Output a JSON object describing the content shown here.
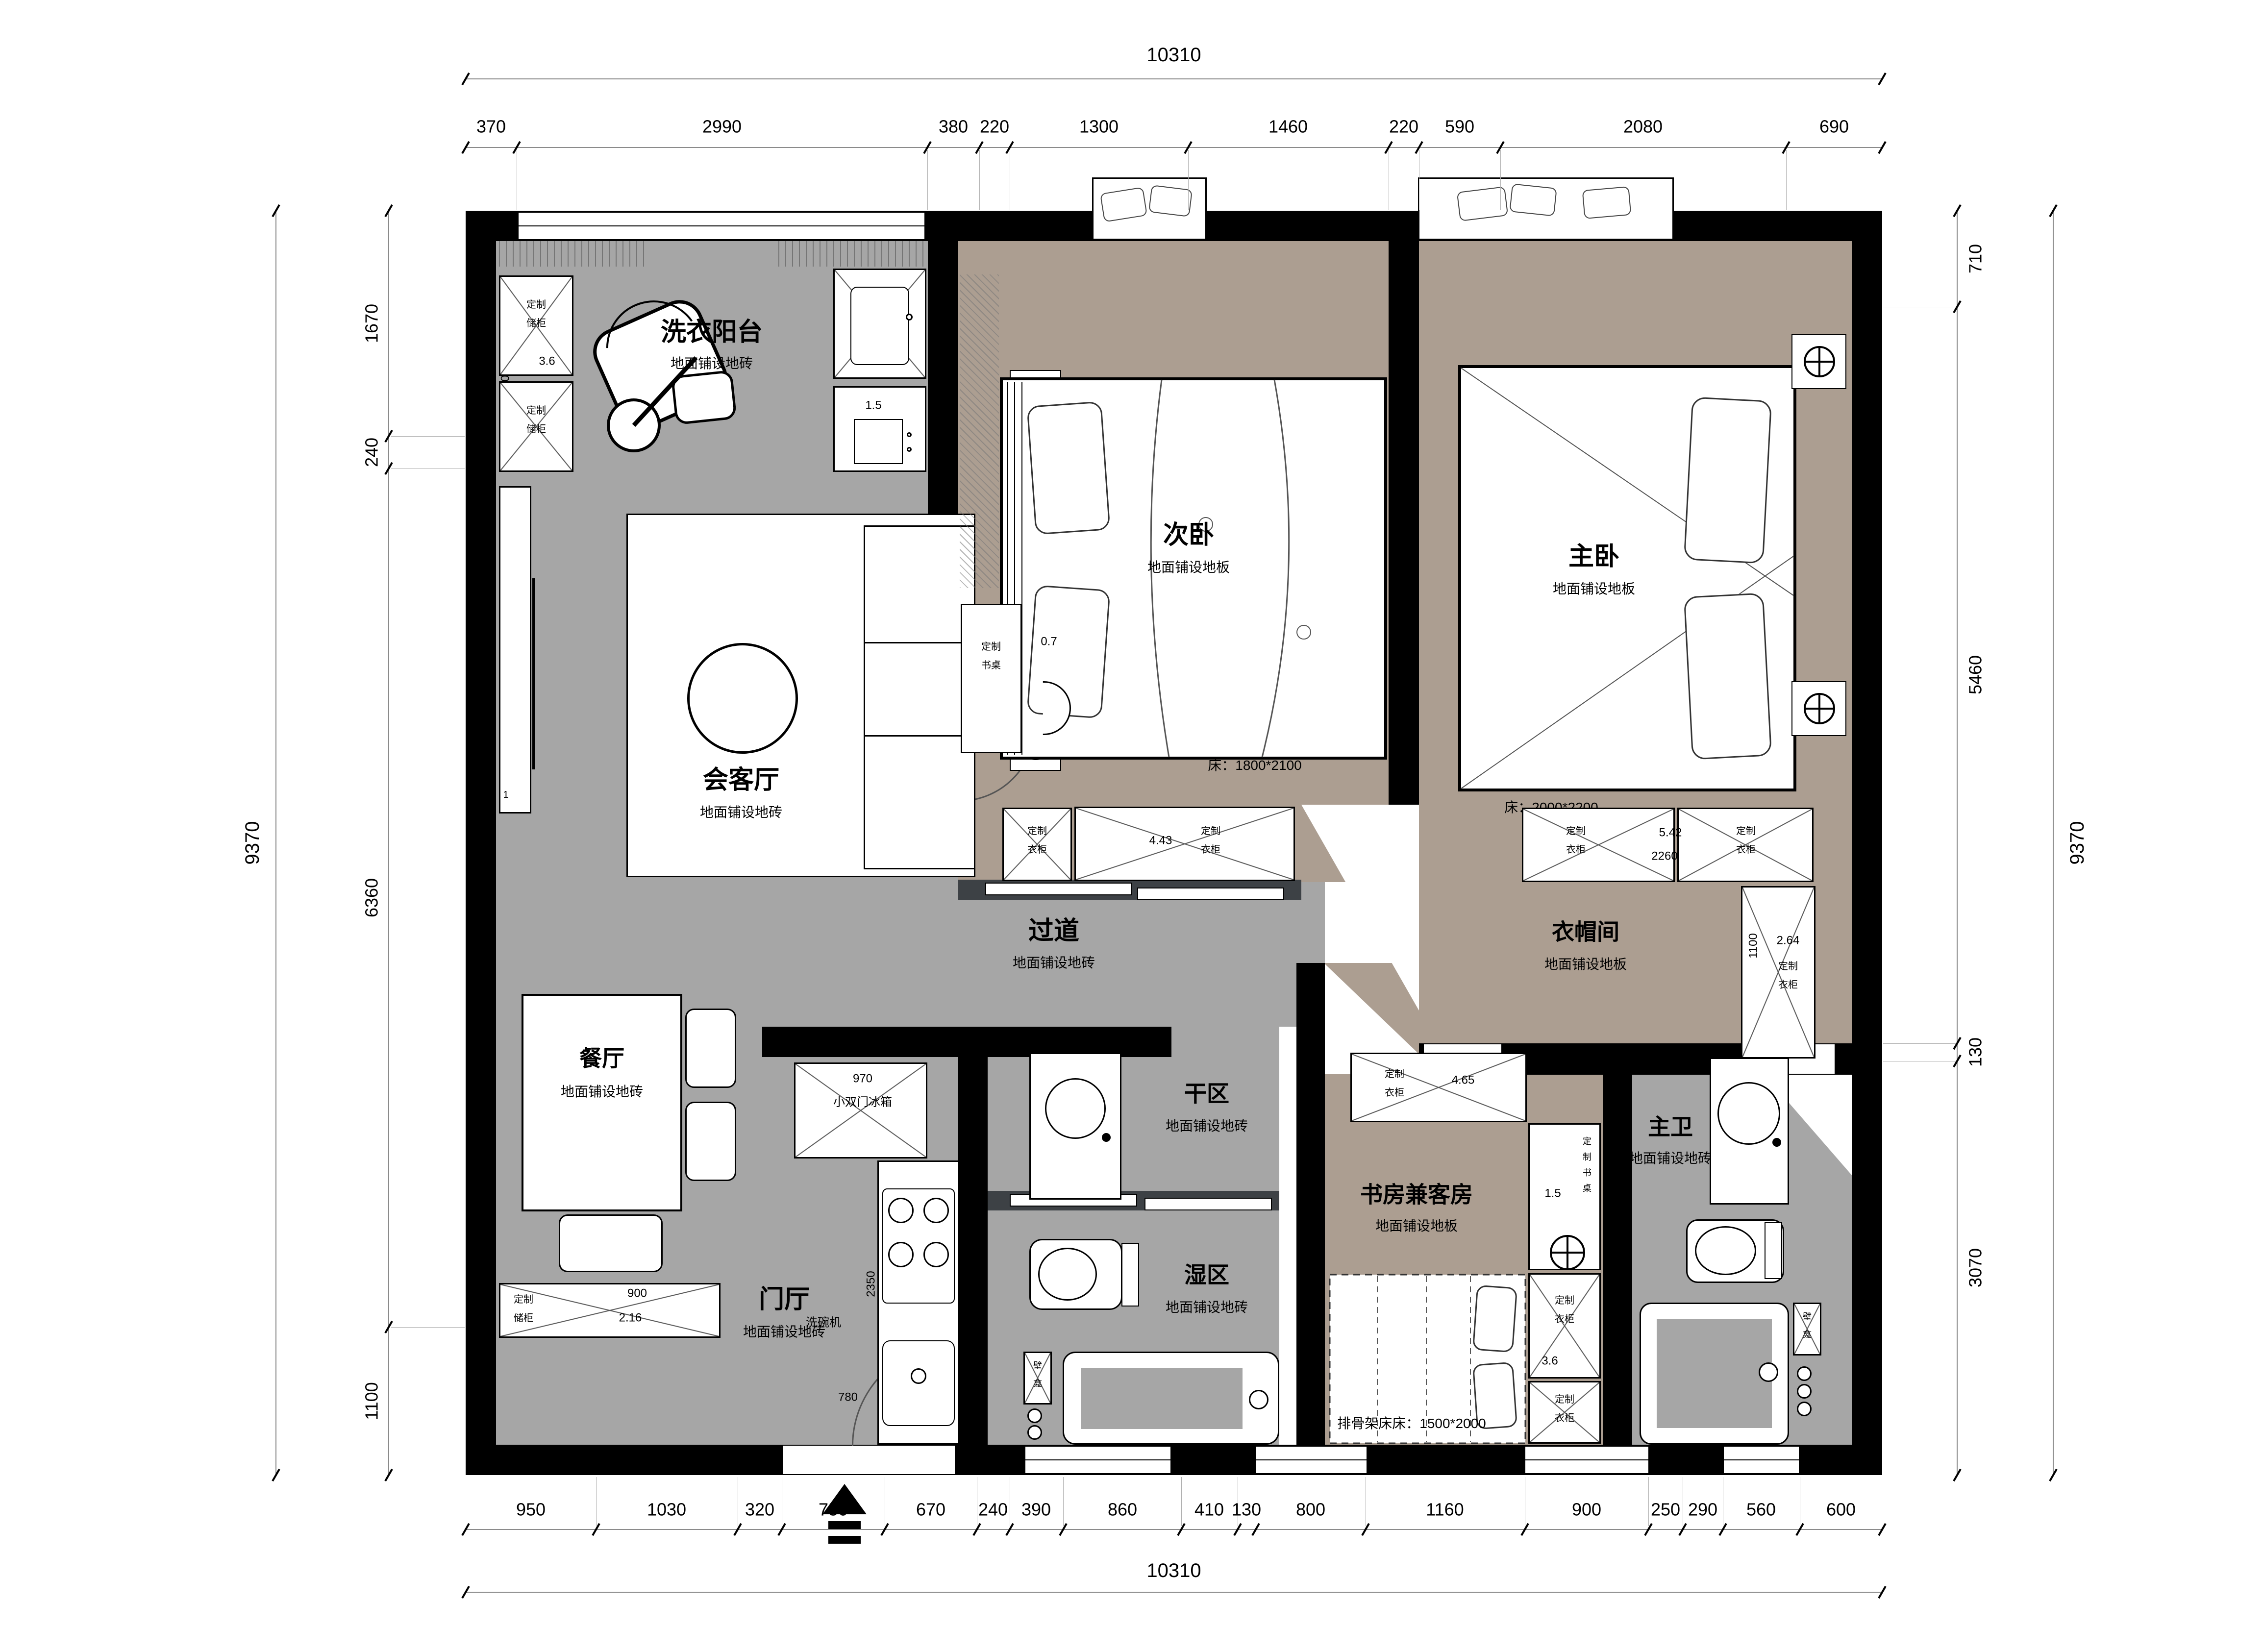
{
  "colors": {
    "wall": "#000000",
    "tile_floor": "#a6a6a6",
    "wood_floor": "#ac9e91",
    "door_track": "#3d4145",
    "dim_line": "#8a8a8a"
  },
  "dims": {
    "top": {
      "total": "10310",
      "segments": [
        "370",
        "2990",
        "380",
        "220",
        "1300",
        "1460",
        "220",
        "590",
        "2080",
        "690"
      ]
    },
    "bottom": {
      "total": "10310",
      "segments": [
        "950",
        "1030",
        "320",
        "750",
        "670",
        "240",
        "390",
        "860",
        "410",
        "130",
        "800",
        "1160",
        "900",
        "250",
        "290",
        "560",
        "600"
      ]
    },
    "left": {
      "total": "9370",
      "segments": [
        "1670",
        "240",
        "6360",
        "1100"
      ]
    },
    "right": {
      "total": "9370",
      "segments": [
        "710",
        "5460",
        "130",
        "3070"
      ]
    }
  },
  "rooms": {
    "laundry": {
      "name": "洗衣阳台",
      "floor": "地面铺设地砖"
    },
    "living": {
      "name": "会客厅",
      "floor": "地面铺设地砖",
      "tag": "1"
    },
    "second_bedroom": {
      "name": "次卧",
      "floor": "地面铺设地板",
      "bed": "床：1800*2100"
    },
    "master_bedroom": {
      "name": "主卧",
      "floor": "地面铺设地板",
      "bed": "床：2000*2200"
    },
    "hallway": {
      "name": "过道",
      "floor": "地面铺设地砖"
    },
    "cloakroom": {
      "name": "衣帽间",
      "floor": "地面铺设地板"
    },
    "dining": {
      "name": "餐厅",
      "floor": "地面铺设地砖"
    },
    "entry": {
      "name": "门厅",
      "floor": "地面铺设地砖"
    },
    "dry_area": {
      "name": "干区",
      "floor": "地面铺设地砖"
    },
    "wet_area": {
      "name": "湿区",
      "floor": "地面铺设地砖"
    },
    "study": {
      "name": "书房兼客房",
      "floor": "地面铺设地板",
      "bed": "排骨架床床：1500*2000"
    },
    "master_bath": {
      "name": "主卫",
      "floor": "地面铺设地砖"
    }
  },
  "fixtures": {
    "laundry_cab_top": {
      "line1": "定制",
      "line2": "储柜",
      "area": "3.6",
      "width": "1500"
    },
    "laundry_cab_bottom": {
      "line1": "定制",
      "line2": "储柜"
    },
    "laundry_sink_area": "1.5",
    "bedroom2_desk": {
      "line1": "定制",
      "line2": "书桌",
      "area": "0.7"
    },
    "bedroom2_wardrobe_a": {
      "line1": "定制",
      "line2": "衣柜"
    },
    "bedroom2_wardrobe_b": {
      "line1": "定制",
      "line2": "衣柜",
      "area": "4.43"
    },
    "cloak_wardrobe_a": {
      "line1": "定制",
      "line2": "衣柜"
    },
    "cloak_wardrobe_b": {
      "line1": "定制",
      "line2": "衣柜"
    },
    "cloak_row": {
      "area": "5.42",
      "width": "2260"
    },
    "cloak_wardrobe_side": {
      "line1": "定制",
      "line2": "衣柜",
      "area": "2.64",
      "width": "1100"
    },
    "entry_cabinet": {
      "line1": "定制",
      "line2": "储柜",
      "width": "900",
      "area": "2.16"
    },
    "fridge": {
      "name": "小双门冰箱",
      "width": "970"
    },
    "dishwasher": "洗碗机",
    "kitchen_dims": {
      "counter": "2350",
      "corridor": "2920",
      "sink": "780"
    },
    "study_wardrobe_top": {
      "line1": "定制",
      "line2": "衣柜",
      "area": "4.65"
    },
    "study_desk": {
      "c1": "定",
      "c2": "制",
      "c3": "书",
      "c4": "桌",
      "area": "1.5"
    },
    "study_wardrobe_mid": {
      "line1": "定制",
      "line2": "衣柜",
      "area": "3.6"
    },
    "study_wardrobe_bottom": {
      "line1": "定制",
      "line2": "衣柜"
    },
    "niche_wet": {
      "c1": "壁",
      "c2": "龛"
    },
    "niche_bath": {
      "c1": "壁",
      "c2": "龛"
    }
  }
}
